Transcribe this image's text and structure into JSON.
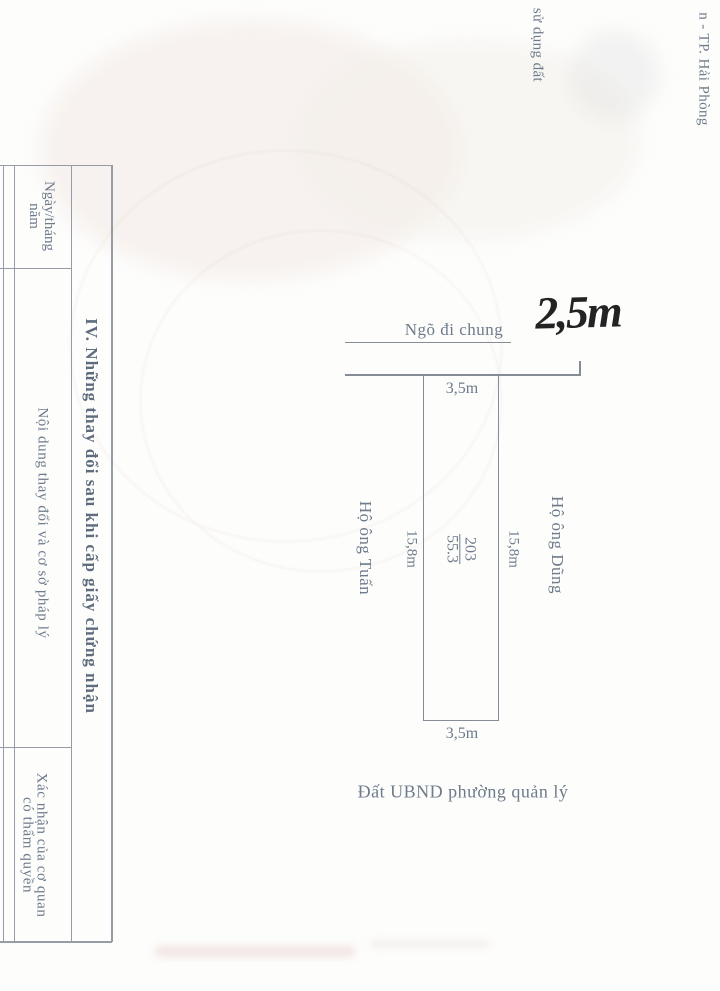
{
  "page": {
    "description_label": "Scanned land-use-right certificate page with parcel sketch",
    "background": "#fdfdfc"
  },
  "colors": {
    "ink": "#6e7b8b",
    "rule_line": "#959ca6",
    "diagram_line": "#868c95",
    "handwriting": "#232323"
  },
  "edge_texts": {
    "top_partial": "sử dụng đất",
    "right_partial": "n - TP. Hải Phòng"
  },
  "section_table": {
    "title": "IV. Những thay đổi sau khi cấp giấy chứng nhận",
    "date_header": {
      "line1": "Ngày/tháng",
      "line2": "năm"
    },
    "content_header": {
      "label": "Nội dung thay đổi và cơ sở pháp lý"
    },
    "confirm_header": {
      "line1": "Xác nhận của cơ quan",
      "line2": "có thẩm quyền"
    }
  },
  "plot_diagram": {
    "alley_label": "Ngõ đi chung",
    "handwritten_width": "2,5m",
    "top_width": "3,5m",
    "bottom_width": "3,5m",
    "left_length": "15,8m",
    "right_length": "15,8m",
    "parcel_number": "203",
    "parcel_area": "55.3",
    "neighbor_left": "Hộ ông Tuấn",
    "neighbor_right": "Hộ ông Dũng",
    "bottom_label": "Đất UBND phường quản lý"
  }
}
